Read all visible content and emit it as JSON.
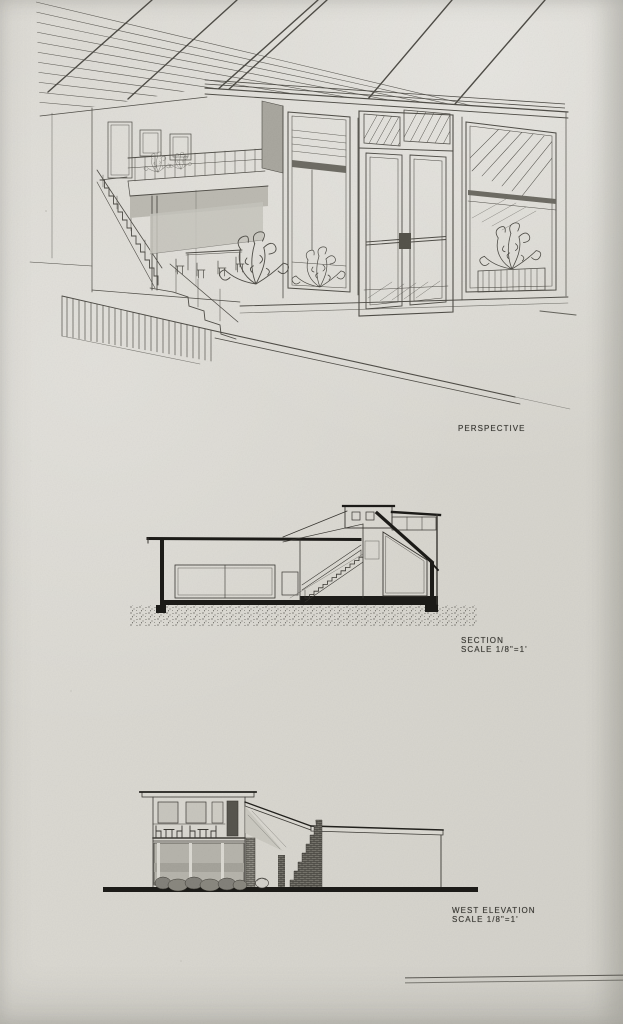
{
  "page": {
    "kind": "architectural drawing sheet",
    "colors": {
      "paper": "#dad8d1",
      "ink": "#4a4843",
      "poche": "#1c1b18",
      "wash": "#b6b4ac"
    }
  },
  "figures": {
    "perspective": {
      "caption": "PERSPECTIVE"
    },
    "section": {
      "caption": "SECTION",
      "scale": "SCALE 1/8\"=1'"
    },
    "west_elevation": {
      "caption": "WEST ELEVATION",
      "scale": "SCALE 1/8\"=1'"
    }
  }
}
